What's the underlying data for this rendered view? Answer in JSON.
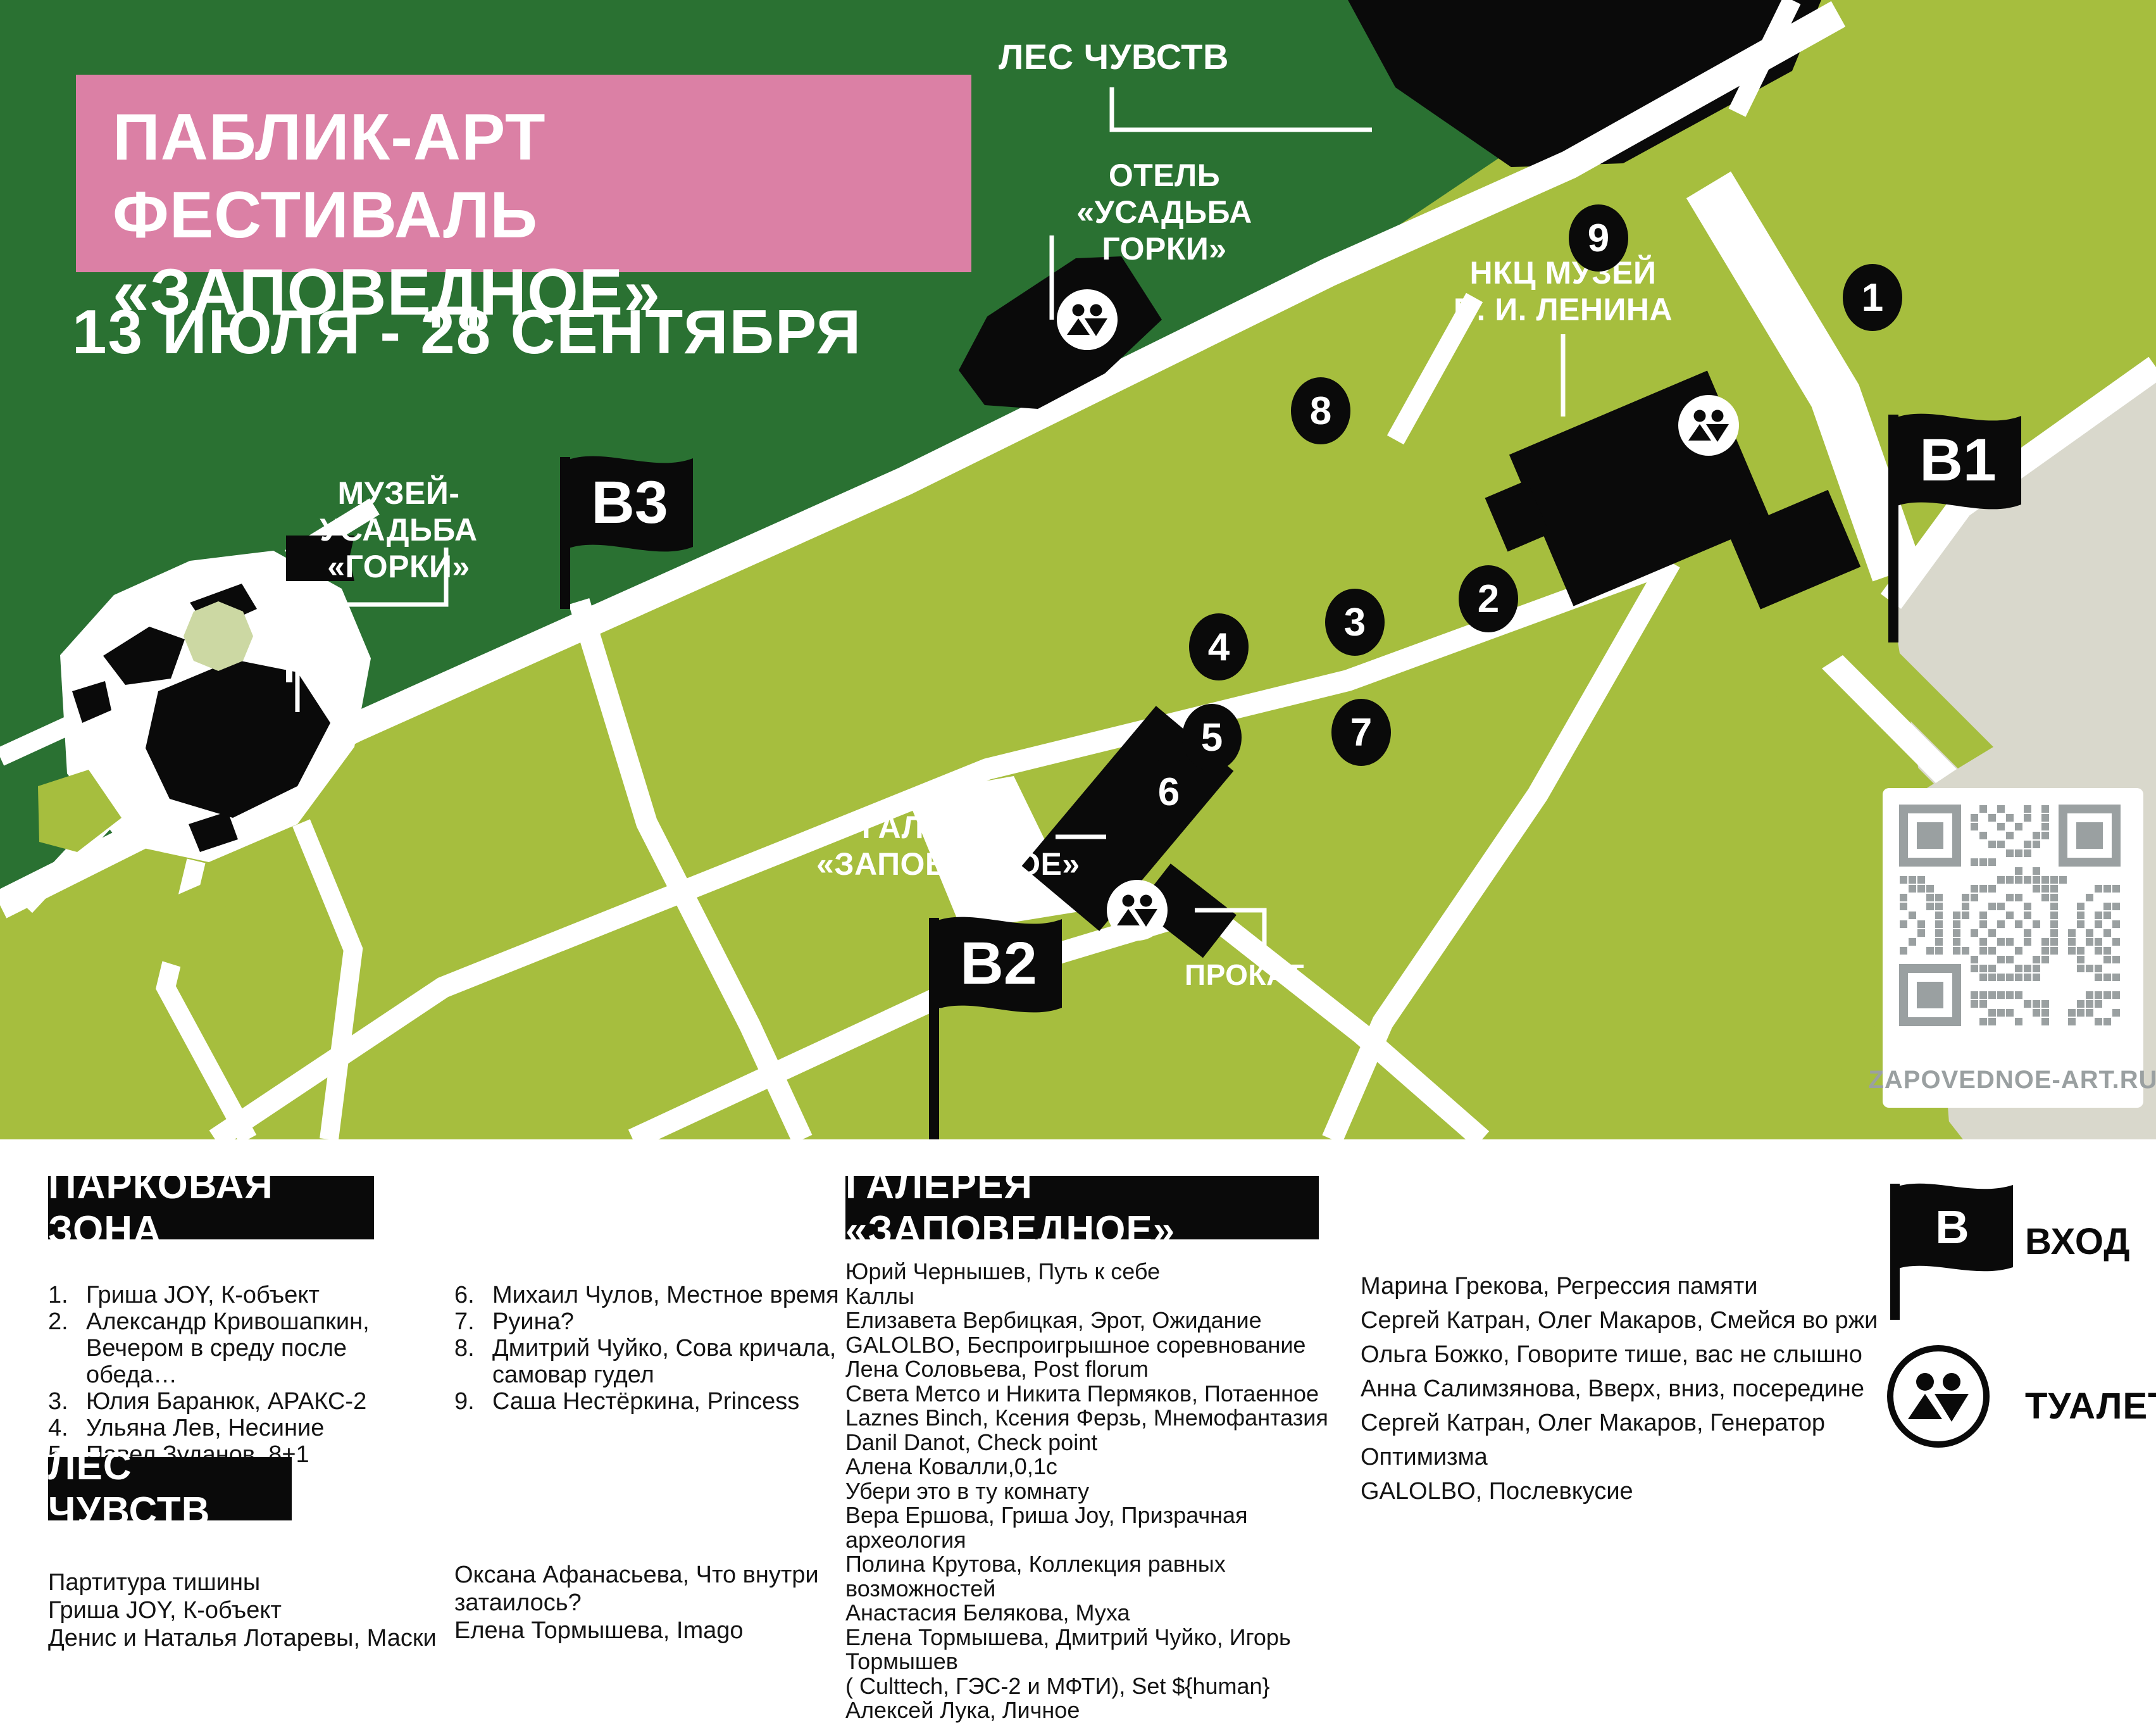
{
  "title": {
    "line1": "ПАБЛИК-АРТ ФЕСТИВАЛЬ",
    "line2": "«ЗАПОВЕДНОЕ»",
    "dates": "13 ИЮЛЯ - 28 СЕНТЯБРЯ"
  },
  "map": {
    "labels": {
      "forest": "ЛЕС ЧУВСТВ",
      "hotel": "ОТЕЛЬ\n«УСАДЬБА ГОРКИ»",
      "lenin_museum": "НКЦ МУЗЕЙ\nВ. И. ЛЕНИНА",
      "gorki_estate": "МУЗЕЙ-УСАДЬБА\n«ГОРКИ»",
      "gallery": "ГАЛЕРЕЯ\n«ЗАПОВЕДНОЕ»",
      "rental": "ПРОКАТ"
    },
    "flags": {
      "b1": "В1",
      "b2": "В2",
      "b3": "В3"
    },
    "markers": [
      "1",
      "2",
      "3",
      "4",
      "5",
      "6",
      "7",
      "8",
      "9"
    ],
    "qr_caption": "ZAPOVEDNOE-ART.RU"
  },
  "legend": {
    "park": {
      "title": "ПАРКОВАЯ ЗОНА",
      "col1": [
        {
          "n": "1.",
          "t": "Гриша JOY, К-объект"
        },
        {
          "n": "2.",
          "t": "Александр Кривошапкин,\nВечером в среду после обеда…"
        },
        {
          "n": "3.",
          "t": "Юлия Баранюк, АРАКС-2"
        },
        {
          "n": "4.",
          "t": "Ульяна Лев, Несиние"
        },
        {
          "n": "5.",
          "t": "Павел Зуданов, 8+1"
        }
      ],
      "col2": [
        {
          "n": "6.",
          "t": "Михаил Чулов, Местное время"
        },
        {
          "n": "7.",
          "t": "Руина?"
        },
        {
          "n": "8.",
          "t": "Дмитрий Чуйко, Сова кричала,\nсамовар гудел"
        },
        {
          "n": "9.",
          "t": "Саша Нестёркина, Princess"
        }
      ]
    },
    "forest": {
      "title": "ЛЕС ЧУВСТВ",
      "col1": [
        "Партитура тишины",
        "Гриша JOY, К-объект",
        "Денис и Наталья Лотаревы, Маски"
      ],
      "col2": [
        "Оксана Афанасьева, Что внутри",
        "затаилось?",
        "Елена Тормышева, Imago"
      ]
    },
    "gallery": {
      "title": "ГАЛЕРЕЯ «ЗАПОВЕДНОЕ»",
      "col1": [
        "Юрий Чернышев, Путь к себе",
        "Каллы",
        "Елизавета Вербицкая, Эрот, Ожидание",
        "GALOLBO, Беспроигрышное соревнование",
        "Лена Соловьева, Post florum",
        "Света Метсо и Никита Пермяков, Потаенное",
        "Laznes Binch, Ксения Ферзь, Мнемофантазия",
        "Danil Danot, Check point",
        "Алена Ковалли,0,1с",
        "Убери это в ту комнату",
        "Вера Ершова, Гриша Joy, Призрачная археология",
        "Полина Крутова, Коллекция равных возможностей",
        "Анастасия Белякова, Муха",
        "Елена Тормышева, Дмитрий Чуйко, Игорь Тормышев",
        "( Culttech, ГЭС-2 и МФТИ), Set ${human}",
        "Алексей Лука, Личное"
      ],
      "col2": [
        "Марина Грекова, Регрессия памяти",
        "Сергей Катран, Олег Макаров, Смейся во ржи",
        "Ольга Божко, Говорите тише, вас не слышно",
        "Анна Салимзянова, Вверх, вниз, посередине",
        "Сергей Катран, Олег Макаров, Генератор",
        "Оптимизма",
        "GALOLBO, Послевкусие"
      ]
    },
    "icons": {
      "entrance": "ВХОД",
      "entrance_flag_letter": "В",
      "toilet": "ТУАЛЕТ"
    }
  },
  "colors": {
    "dark_green": "#2a7132",
    "light_green": "#a6be3e",
    "pale_green": "#ccd8a3",
    "pink": "#db80a5",
    "gray_land": "#d9d8cc",
    "qr_gray": "#9aa0a1",
    "black": "#0a0a0a"
  }
}
